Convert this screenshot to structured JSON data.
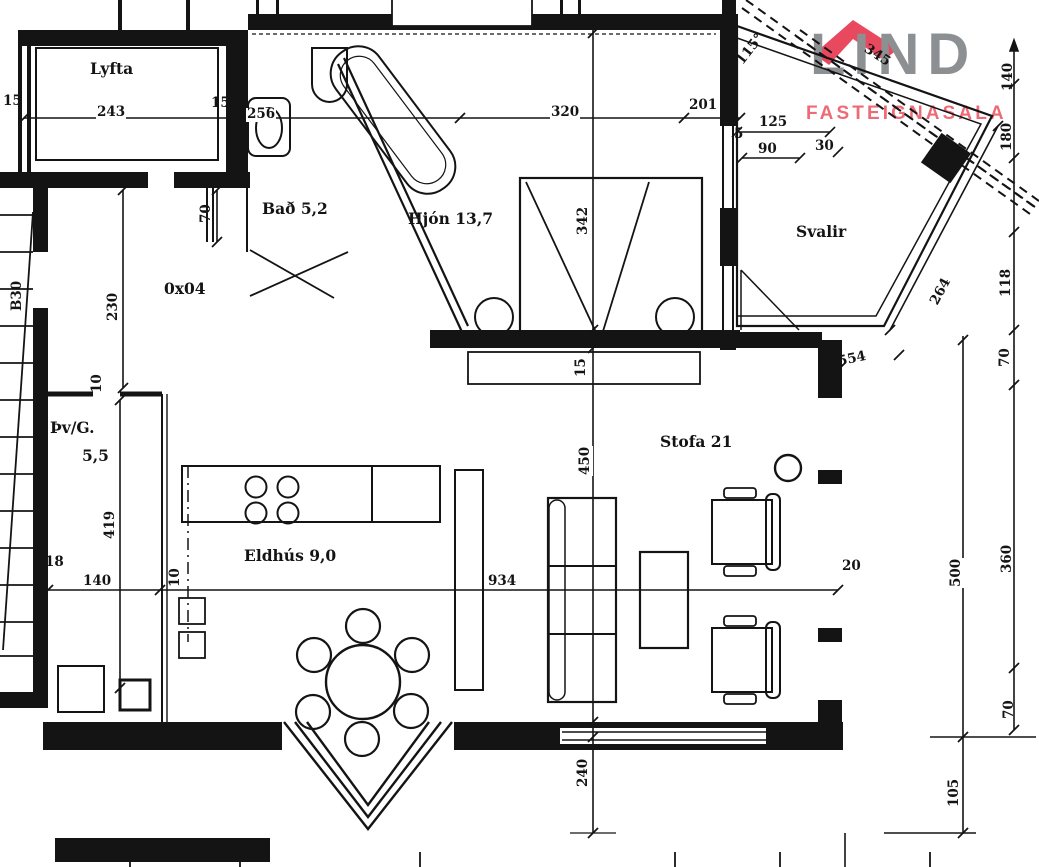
{
  "logo": {
    "brand": "LIND",
    "subtitle": "FASTEIGNASALA",
    "brand_color": "#8d9092",
    "subtitle_color": "#ed6b76",
    "roof_color": "#e8495e"
  },
  "rooms": {
    "lyfta": "Lyfta",
    "bath": "Bað 5,2",
    "bedroom": "Hjón 13,7",
    "balcony": "Svalir",
    "hall": "0x04",
    "laundry": "Þv/G.",
    "laundry_area": "5,5",
    "kitchen": "Eldhús 9,0",
    "living": "Stofa 21"
  },
  "dims": {
    "t15a": "15",
    "t243": "243",
    "t15b": "15",
    "t256": "256",
    "t320": "320",
    "t201": "201",
    "t125": "125",
    "t5": "5",
    "t90": "90",
    "t30": "30",
    "t115": "115°",
    "t345": "345",
    "t140r": "140",
    "t180": "180",
    "t118": "118",
    "t264": "264",
    "t554": "554",
    "t70a": "70",
    "t360": "360",
    "t500": "500",
    "t70b": "70",
    "t105": "105",
    "t20": "20",
    "t70c": "70",
    "t230": "230",
    "tB30": "B30",
    "t10a": "10",
    "t419": "419",
    "t10b": "10",
    "t18": "18",
    "t140l": "140",
    "t934": "934",
    "t342": "342",
    "t15c": "15",
    "t450": "450",
    "t240": "240"
  }
}
